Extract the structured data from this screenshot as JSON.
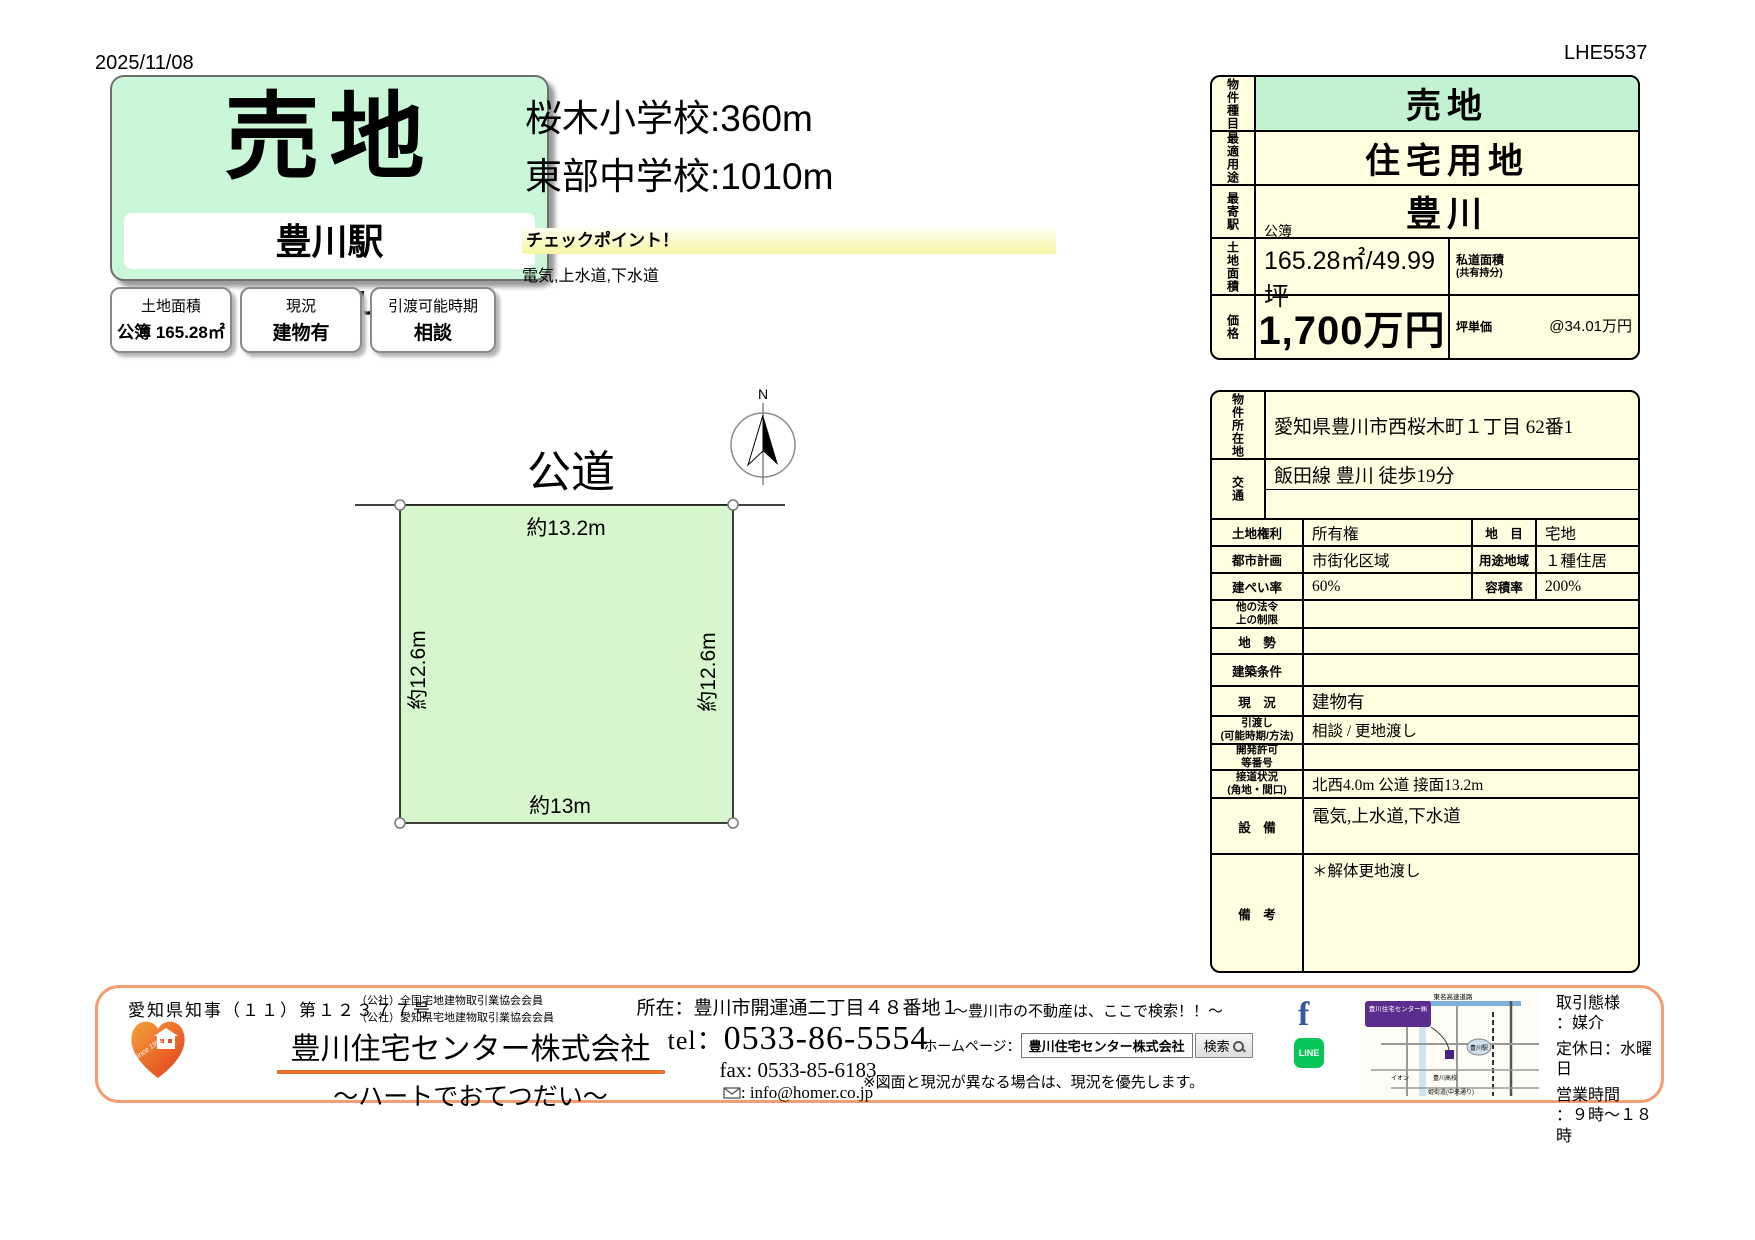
{
  "page": {
    "date": "2025/11/08",
    "code": "LHE5537"
  },
  "colors": {
    "frame_green": "#0d9a4b",
    "mint": "#c9f7d8",
    "table_green": "#c3f2d2",
    "cream": "#fffee1",
    "plot_green": "#d8f6cd",
    "checkpoint_yellow": "#f5f5a2",
    "footer_orange": "#f29d72",
    "brand_orange": "#e8742c",
    "facebook_blue": "#3457a0",
    "line_green": "#06c755"
  },
  "hero": {
    "title": "売地",
    "station": "豊川駅",
    "delivery": "更地渡し",
    "cards": [
      {
        "label": "土地面積",
        "value": "公簿 165.28㎡"
      },
      {
        "label": "現況",
        "value": "建物有"
      },
      {
        "label": "引渡可能時期",
        "value": "相談"
      }
    ]
  },
  "highlights": {
    "school1": "桜木小学校:360m",
    "school2": "東部中学校:1010m",
    "checkpoint_title": "チェックポイント！",
    "checkpoint_body": "電気,上水道,下水道"
  },
  "plot": {
    "road_label": "公道",
    "compass_label": "N",
    "dim_top": "約13.2m",
    "dim_left": "約12.6m",
    "dim_right": "約12.6m",
    "dim_bottom": "約13m"
  },
  "summary": {
    "rows": [
      {
        "label": "物件種目",
        "value": "売地"
      },
      {
        "label": "最適用途",
        "value": "住宅用地"
      },
      {
        "label": "最寄駅",
        "value": "豊川"
      }
    ],
    "area": {
      "label": "土地面積",
      "note": "公簿",
      "value": "165.28㎡/49.99坪",
      "side_label": "私道面積",
      "side_sub": "(共有持分)",
      "side_value": ""
    },
    "price": {
      "label": "価格",
      "value": "1,700万円",
      "unit_label": "坪単価",
      "unit_value": "@34.01万円"
    }
  },
  "detail": {
    "location": {
      "label": "物件所在地",
      "value": "愛知県豊川市西桜木町１丁目 62番1"
    },
    "transport": {
      "label": "交通",
      "value": "飯田線 豊川 徒歩19分",
      "value2": ""
    },
    "pairs": [
      {
        "l1": "土地権利",
        "v1": "所有権",
        "l2": "地　目",
        "v2": "宅地"
      },
      {
        "l1": "都市計画",
        "v1": "市街化区域",
        "l2": "用途地域",
        "v2": "１種住居"
      },
      {
        "l1": "建ぺい率",
        "v1": "60%",
        "l2": "容積率",
        "v2": "200%"
      }
    ],
    "rows": [
      {
        "label": "他の法令\n上の制限",
        "value": ""
      },
      {
        "label": "地　勢",
        "value": ""
      },
      {
        "label": "建築条件",
        "value": ""
      },
      {
        "label": "現　況",
        "value": "建物有"
      },
      {
        "label": "引渡し\n(可能時期/方法)",
        "value": "相談 / 更地渡し"
      },
      {
        "label": "開発許可\n等番号",
        "value": ""
      },
      {
        "label": "接道状況\n(角地・間口)",
        "value": "北西4.0m 公道 接面13.2m"
      },
      {
        "label": "設　備",
        "value": "電気,上水道,下水道"
      },
      {
        "label": "備　考",
        "value": "＊解体更地渡し"
      }
    ]
  },
  "footer": {
    "license": "愛知県知事（１１）第１２３７７号",
    "memberships": [
      "（公社）全国宅地建物取引業協会会員",
      "（公社）愛知県宅地建物取引業協会会員"
    ],
    "logo_since": "since 1982",
    "company": "豊川住宅センター株式会社",
    "tagline": "～ハートでおてつだい～",
    "address": "所在：豊川市開運通二丁目４８番地１",
    "tel_label": "tel：",
    "tel": "0533-86-5554",
    "fax_label": "fax: ",
    "fax": "0533-85-6183",
    "email": ": info@homer.co.jp",
    "search_banner": "～豊川市の不動産は、ここで検索！！～",
    "homepage_label": "ホームページ：",
    "homepage_box": "豊川住宅センター株式会社",
    "search_button": "検索",
    "disclaimer": "※図面と現況が異なる場合は、現況を優先します。",
    "sns": {
      "facebook": "f",
      "line": "LINE"
    },
    "map_labels": {
      "top_road": "東名高速道路",
      "office": "豊川住宅センター㈱",
      "station": "豊川駅",
      "school": "豊川高校",
      "store": "イオン",
      "bottom_road": "姫街道(中央通り)"
    },
    "right": {
      "l1": "取引態様",
      "l1b": "：媒介",
      "l2": "定休日：水曜日",
      "l3": "営業時間",
      "l3b": "：９時～１８時"
    }
  }
}
